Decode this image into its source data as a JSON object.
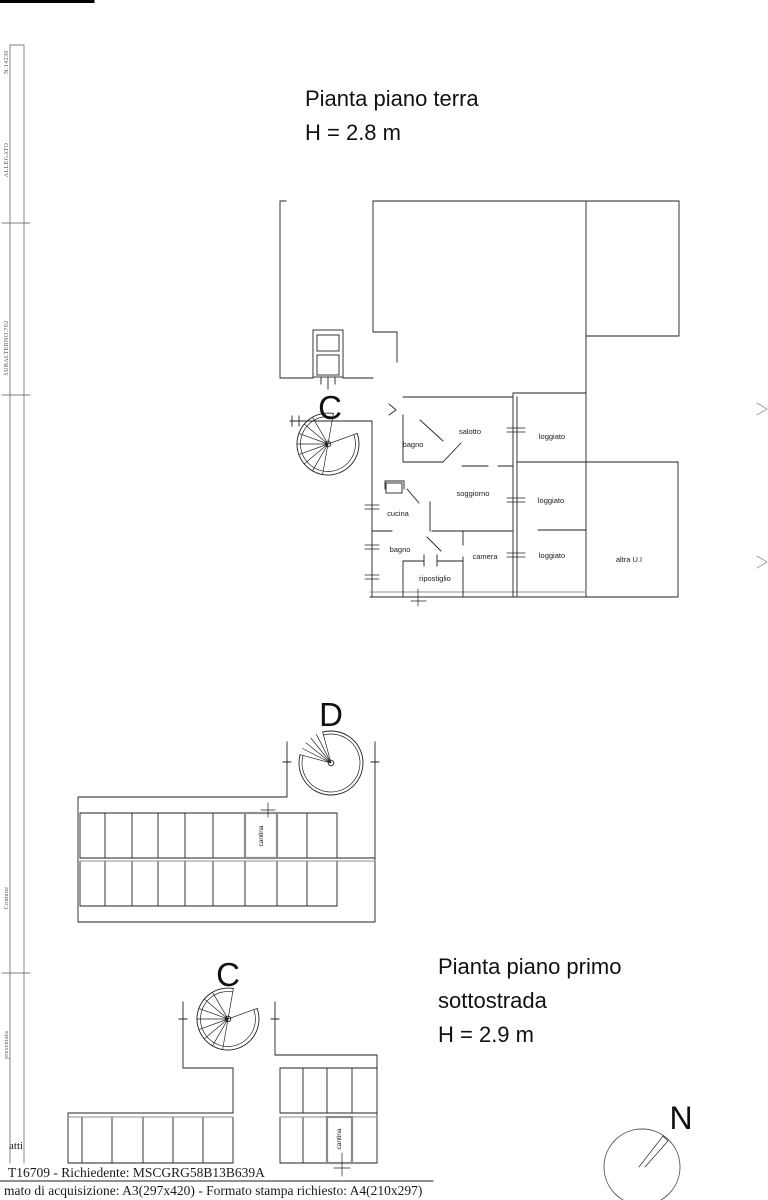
{
  "colors": {
    "line": "#1c1c1c",
    "cantina_highlight": "#8c8c8c"
  },
  "ground_floor": {
    "title": "Pianta piano terra",
    "height_note": "H = 2.8 m",
    "section_label": "C",
    "rooms": [
      "bagno",
      "salotto",
      "loggiato",
      "cucina",
      "soggiorno",
      "loggiato",
      "bagno",
      "camera",
      "loggiato",
      "ripostiglio",
      "altra U.I"
    ]
  },
  "basement": {
    "title_line1": "Pianta piano primo",
    "title_line2": "sottostrada",
    "height_note": "H = 2.9 m",
    "section_label_d": "D",
    "section_label_c": "C",
    "cantina_upper_label": "cantina",
    "cantina_lower_label": "cantina"
  },
  "compass": {
    "label": "N"
  },
  "footer": {
    "note_fragment": "atti",
    "line1": "T16709 - Richiedente: MSCGRG58B13B639A",
    "line2": "mato di acquisizione: A3(297x420)  - Formato stampa richiesto: A4(210x297)"
  },
  "margin_notes": {
    "frag1": "N.14230",
    "frag2": "ALLEGATO",
    "frag3": "SUBALTERNO.702",
    "frag4": "Comune",
    "frag5": "presentata"
  }
}
